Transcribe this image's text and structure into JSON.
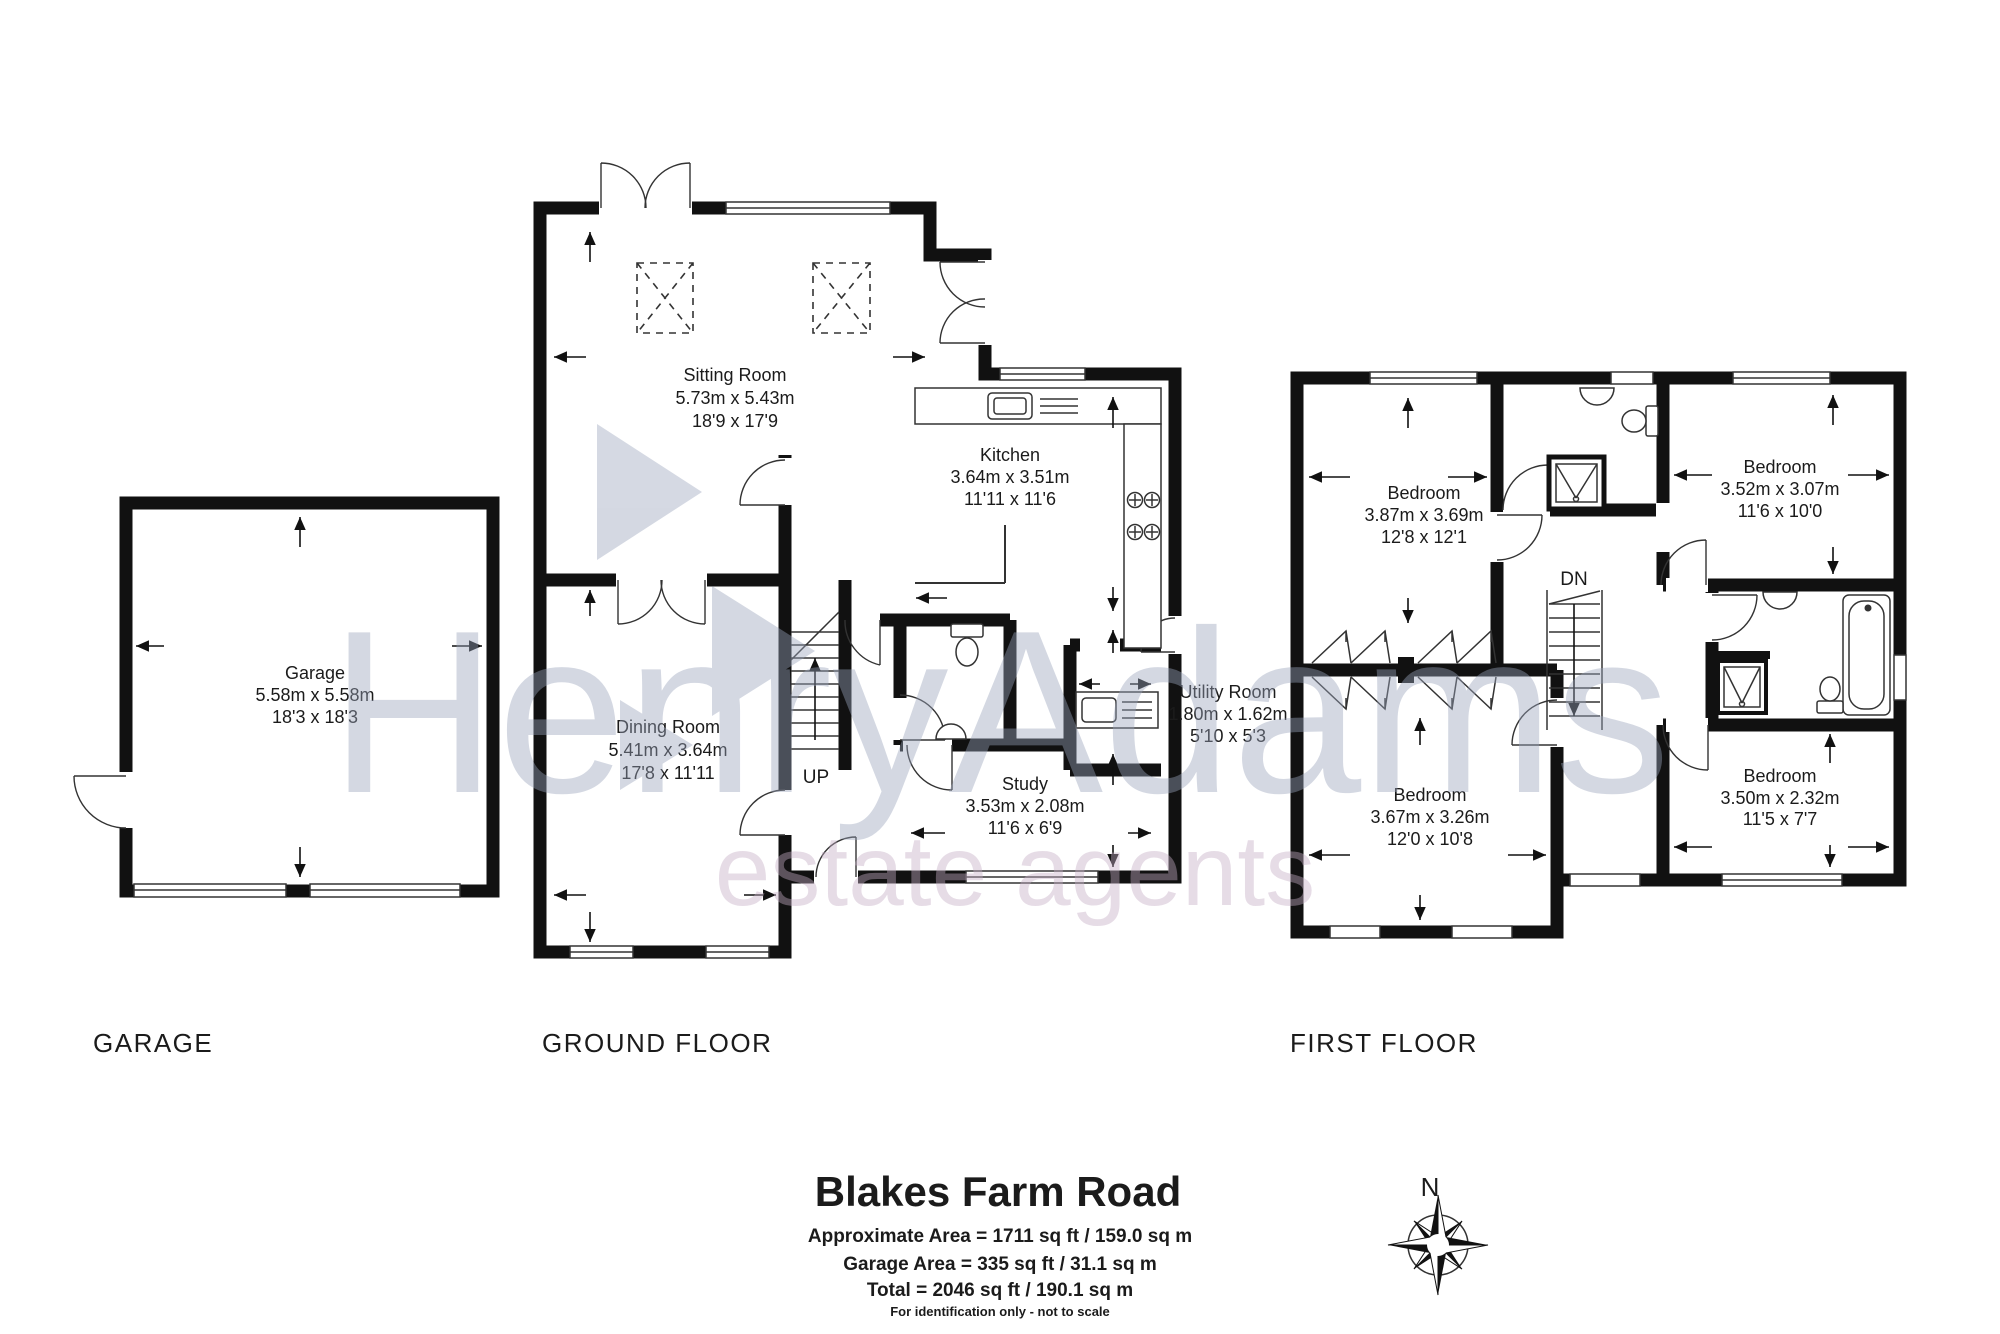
{
  "watermark": {
    "line1": "HenryAdams",
    "line2": "estate agents"
  },
  "colors": {
    "wall": "#111111",
    "room_fill": "#b8dce8",
    "garage_fill": "#eef0d2",
    "watermark_blue": "#9aa4bc",
    "watermark_pink": "#c6aec6"
  },
  "garage": {
    "name": "Garage",
    "metric": "5.58m x 5.58m",
    "imperial": "18'3 x 18'3"
  },
  "ground": {
    "sitting": {
      "name": "Sitting Room",
      "metric": "5.73m x 5.43m",
      "imperial": "18'9 x 17'9"
    },
    "kitchen": {
      "name": "Kitchen",
      "metric": "3.64m x 3.51m",
      "imperial": "11'11 x 11'6"
    },
    "dining": {
      "name": "Dining Room",
      "metric": "5.41m x 3.64m",
      "imperial": "17'8 x 11'11"
    },
    "study": {
      "name": "Study",
      "metric": "3.53m x 2.08m",
      "imperial": "11'6 x 6'9"
    },
    "utility": {
      "name": "Utility Room",
      "metric": "1.80m x 1.62m",
      "imperial": "5'10 x 5'3"
    },
    "stairs_label": "UP"
  },
  "first": {
    "bed1": {
      "name": "Bedroom",
      "metric": "3.87m x 3.69m",
      "imperial": "12'8 x 12'1"
    },
    "bed2": {
      "name": "Bedroom",
      "metric": "3.52m x 3.07m",
      "imperial": "11'6 x 10'0"
    },
    "bed3": {
      "name": "Bedroom",
      "metric": "3.67m x 3.26m",
      "imperial": "12'0 x 10'8"
    },
    "bed4": {
      "name": "Bedroom",
      "metric": "3.50m x 2.32m",
      "imperial": "11'5 x 7'7"
    },
    "stairs_label": "DN"
  },
  "floor_labels": {
    "garage": "GARAGE",
    "ground": "GROUND FLOOR",
    "first": "FIRST FLOOR"
  },
  "title_block": {
    "title": "Blakes Farm Road",
    "line1": "Approximate Area = 1711 sq ft / 159.0 sq m",
    "line2": "Garage Area = 335 sq ft / 31.1 sq m",
    "line3": "Total  = 2046 sq ft / 190.1 sq m",
    "note": "For identification only - not to scale"
  },
  "compass": {
    "north": "N"
  }
}
